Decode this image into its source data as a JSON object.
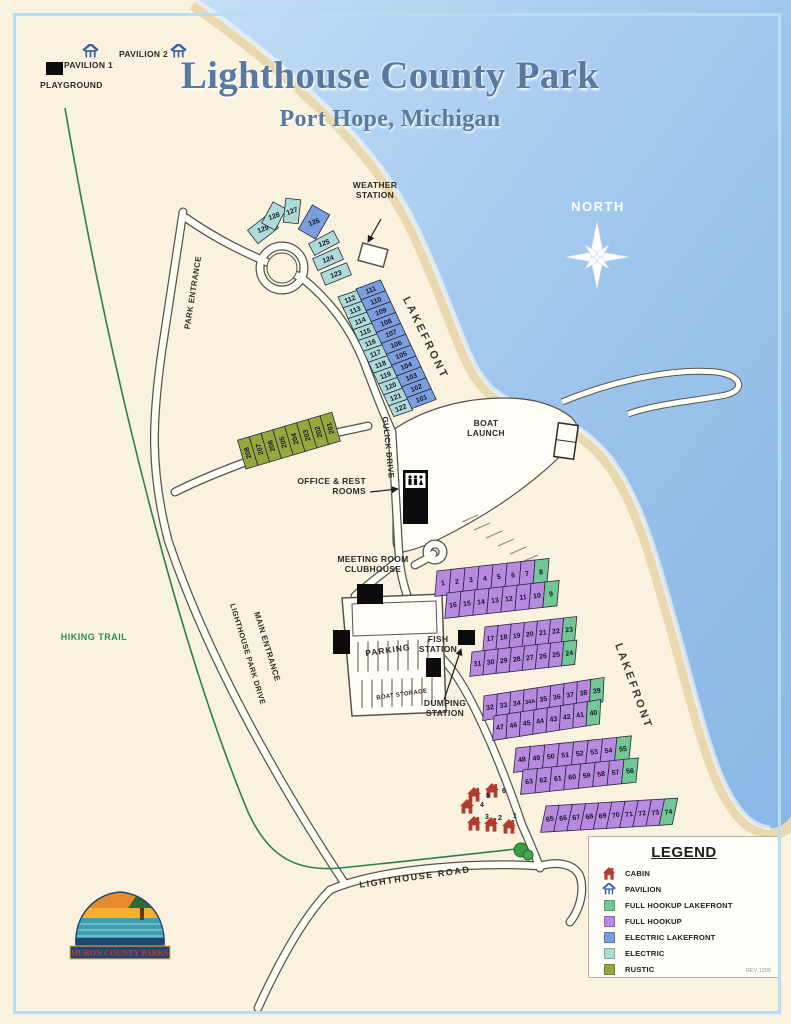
{
  "title": {
    "main": "Lighthouse County Park",
    "subtitle": "Port Hope, Michigan"
  },
  "compass": {
    "label": "NORTH"
  },
  "poi": {
    "pavilion1": "PAVILION 1",
    "pavilion2": "PAVILION 2",
    "playground": "PLAYGROUND",
    "weather_station": "WEATHER STATION",
    "boat_launch": "BOAT LAUNCH",
    "office": "OFFICE & REST ROOMS",
    "meeting_room": "MEETING ROOM CLUBHOUSE",
    "parking": "PARKING",
    "fish_station": "FISH STATION",
    "boat_storage": "BOAT STORAGE",
    "dumping_station": "DUMPING STATION",
    "hiking_trail": "HIKING TRAIL"
  },
  "roads": {
    "park_entrance": "PARK ENTRANCE",
    "lighthouse_park_drive": "LIGHTHOUSE PARK DRIVE",
    "main_entrance": "MAIN ENTRANCE",
    "gulick_drive": "GULICK DRIVE",
    "lighthouse_road": "LIGHTHOUSE ROAD",
    "lakefront_upper": "LAKEFRONT",
    "lakefront_lower": "LAKEFRONT"
  },
  "legend": {
    "title": "LEGEND",
    "rev": "REV 1209",
    "items": [
      {
        "key": "cabin",
        "label": "CABIN"
      },
      {
        "key": "pavilion",
        "label": "PAVILION"
      },
      {
        "key": "full_hookup_lakefront",
        "label": "FULL HOOKUP LAKEFRONT"
      },
      {
        "key": "full_hookup",
        "label": "FULL HOOKUP"
      },
      {
        "key": "electric_lakefront",
        "label": "ELECTRIC LAKEFRONT"
      },
      {
        "key": "electric",
        "label": "ELECTRIC"
      },
      {
        "key": "rustic",
        "label": "RUSTIC"
      }
    ]
  },
  "logo": {
    "text": "HURON COUNTY PARKS"
  },
  "site_colors": {
    "full_hookup_lakefront": "#72c794",
    "full_hookup": "#b78ae0",
    "electric_lakefront": "#7b9fdc",
    "electric": "#aedbd6",
    "rustic": "#97a73c"
  },
  "site_rows": [
    {
      "id": "electric_inner",
      "type": "electric",
      "labels": [
        "112",
        "113",
        "114",
        "115",
        "116",
        "117",
        "118",
        "119",
        "120",
        "121",
        "122"
      ]
    },
    {
      "id": "electric_lakefront_outer",
      "type": "electric_lakefront",
      "labels": [
        "111",
        "110",
        "109",
        "108",
        "107",
        "106",
        "105",
        "104",
        "103",
        "102",
        "101"
      ]
    },
    {
      "id": "rustic_row",
      "type": "rustic",
      "labels": [
        "208",
        "207",
        "206",
        "205",
        "204",
        "203",
        "202",
        "201"
      ]
    },
    {
      "id": "block_a_top",
      "type": "full_hookup",
      "last_type": "full_hookup_lakefront",
      "labels": [
        "1",
        "2",
        "3",
        "4",
        "5",
        "6",
        "7",
        "8"
      ]
    },
    {
      "id": "block_a_bottom",
      "type": "full_hookup",
      "last_type": "full_hookup_lakefront",
      "labels": [
        "16",
        "15",
        "14",
        "13",
        "12",
        "11",
        "10",
        "9"
      ]
    },
    {
      "id": "block_b_top",
      "type": "full_hookup",
      "last_type": "full_hookup_lakefront",
      "labels": [
        "17",
        "18",
        "19",
        "20",
        "21",
        "22",
        "23"
      ]
    },
    {
      "id": "block_b_bottom",
      "type": "full_hookup",
      "last_type": "full_hookup_lakefront",
      "labels": [
        "31",
        "30",
        "29",
        "28",
        "27",
        "26",
        "25",
        "24"
      ]
    },
    {
      "id": "block_c_top",
      "type": "full_hookup",
      "last_type": "full_hookup_lakefront",
      "labels": [
        "32",
        "33",
        "34",
        "34A",
        "35",
        "36",
        "37",
        "38",
        "39"
      ]
    },
    {
      "id": "block_c_bottom",
      "type": "full_hookup",
      "last_type": "full_hookup_lakefront",
      "labels": [
        "47",
        "46",
        "45",
        "44",
        "43",
        "42",
        "41",
        "40"
      ]
    },
    {
      "id": "block_d_top",
      "type": "full_hookup",
      "last_type": "full_hookup_lakefront",
      "labels": [
        "48",
        "49",
        "50",
        "51",
        "52",
        "53",
        "54",
        "55"
      ]
    },
    {
      "id": "block_d_bottom",
      "type": "full_hookup",
      "last_type": "full_hookup_lakefront",
      "labels": [
        "63",
        "62",
        "61",
        "60",
        "59",
        "58",
        "57",
        "56"
      ]
    },
    {
      "id": "block_e",
      "type": "full_hookup",
      "last_type": "full_hookup_lakefront",
      "labels": [
        "65",
        "66",
        "67",
        "68",
        "69",
        "70",
        "71",
        "72",
        "73",
        "74"
      ]
    }
  ],
  "site_cluster": [
    {
      "label": "129",
      "type": "electric"
    },
    {
      "label": "128",
      "type": "electric"
    },
    {
      "label": "127",
      "type": "electric"
    },
    {
      "label": "126",
      "type": "electric_lakefront"
    },
    {
      "label": "125",
      "type": "electric"
    },
    {
      "label": "124",
      "type": "electric"
    },
    {
      "label": "123",
      "type": "electric"
    }
  ],
  "cabins": [
    "6",
    "5",
    "4",
    "3",
    "2",
    "1"
  ]
}
